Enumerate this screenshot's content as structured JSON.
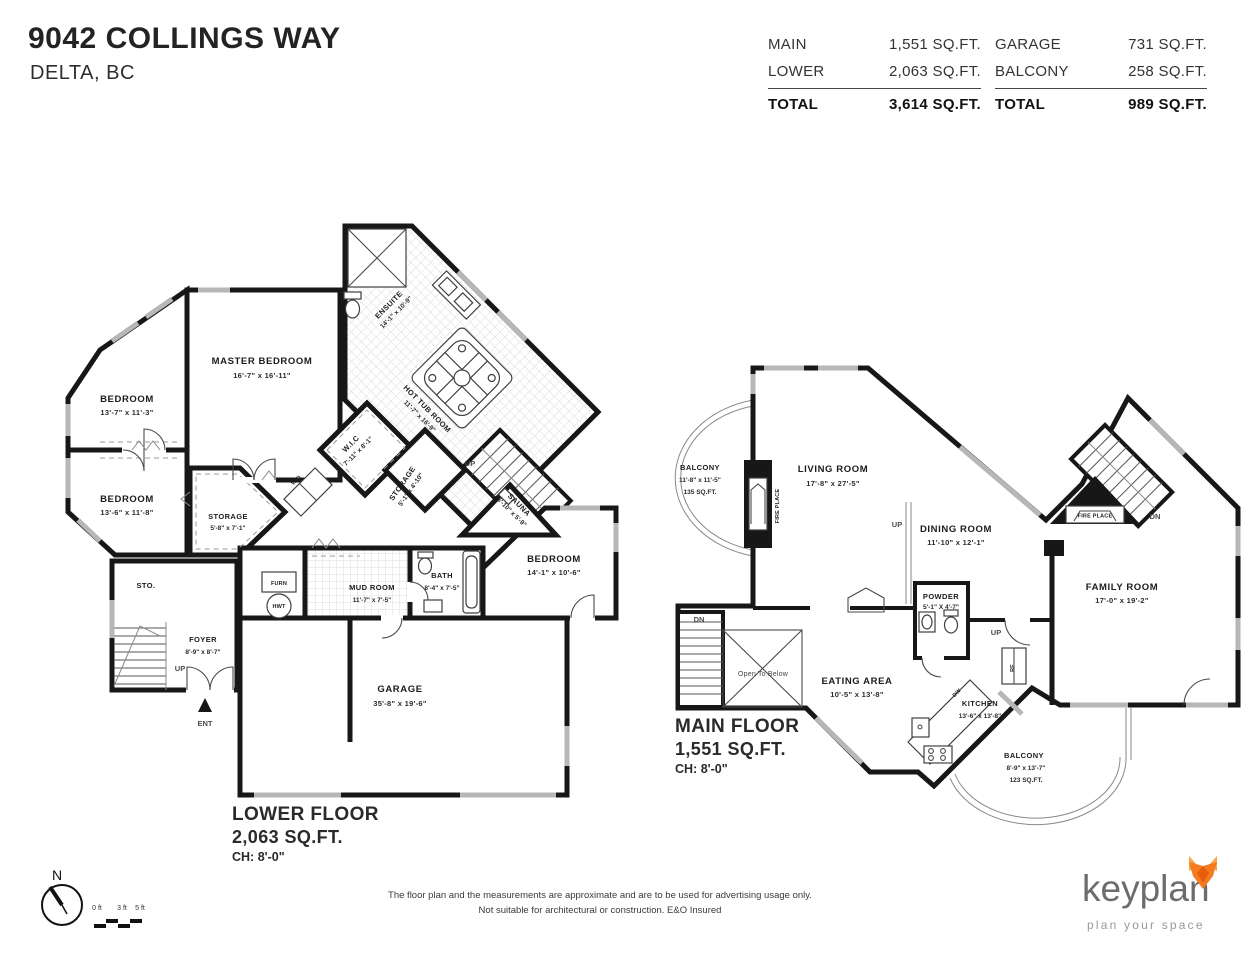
{
  "header": {
    "address": "9042 COLLINGS WAY",
    "city": "DELTA, BC",
    "table": {
      "left": {
        "rows": [
          {
            "label": "MAIN",
            "value": "1,551 SQ.FT."
          },
          {
            "label": "LOWER",
            "value": "2,063 SQ.FT."
          }
        ],
        "total_label": "TOTAL",
        "total_value": "3,614 SQ.FT."
      },
      "right": {
        "rows": [
          {
            "label": "GARAGE",
            "value": "731 SQ.FT."
          },
          {
            "label": "BALCONY",
            "value": "258 SQ.FT."
          }
        ],
        "total_label": "TOTAL",
        "total_value": "989 SQ.FT."
      }
    }
  },
  "lower_floor": {
    "title": "LOWER FLOOR",
    "area": "2,063 SQ.FT.",
    "ceiling": "CH: 8'-0\"",
    "rooms": {
      "master": {
        "name": "MASTER BEDROOM",
        "dims": "16'-7\" x 16'-11\""
      },
      "bedroom1": {
        "name": "BEDROOM",
        "dims": "13'-7\" x 11'-3\""
      },
      "bedroom2": {
        "name": "BEDROOM",
        "dims": "13'-6\" x 11'-8\""
      },
      "ensuite": {
        "name": "ENSUITE",
        "dims": "14'-1\" x 10'-9\""
      },
      "hot_tub": {
        "name": "HOT TUB ROOM",
        "dims": "11'-7\" x 16'-9\""
      },
      "wic": {
        "name": "W.I.C",
        "dims": "7'-11\" x 8'-1\""
      },
      "storage1": {
        "name": "STORAGE",
        "dims": "5'-8\" x 7'-1\""
      },
      "storage2": {
        "name": "STORAGE",
        "dims": "5'-1\" x 4'-10\""
      },
      "sauna": {
        "name": "SAUNA",
        "dims": "5'-10\" x 5'-9\""
      },
      "bedroom3": {
        "name": "BEDROOM",
        "dims": "14'-1\" x 10'-6\""
      },
      "mud_room": {
        "name": "MUD ROOM",
        "dims": "11'-7\" x 7'-5\""
      },
      "bath": {
        "name": "BATH",
        "dims": "8'-4\" x 7'-5\""
      },
      "sto": {
        "name": "STO."
      },
      "foyer": {
        "name": "FOYER",
        "dims": "8'-9\" x 8'-7\""
      },
      "garage": {
        "name": "GARAGE",
        "dims": "35'-8\" x 19'-6\""
      }
    },
    "labels": {
      "furn": "FURN",
      "hwt": "HWT",
      "wd": "W/D",
      "up_stairs": "UP",
      "up_foyer": "UP",
      "ent": "ENT"
    }
  },
  "main_floor": {
    "title": "MAIN FLOOR",
    "area": "1,551 SQ.FT.",
    "ceiling": "CH: 8'-0\"",
    "rooms": {
      "balcony_top": {
        "name": "BALCONY",
        "dims": "11'-8\" x 11'-5\"",
        "area": "135 SQ.FT."
      },
      "living": {
        "name": "LIVING ROOM",
        "dims": "17'-8\" x 27'-5\""
      },
      "dining": {
        "name": "DINING ROOM",
        "dims": "11'-10\" x 12'-1\""
      },
      "powder": {
        "name": "POWDER",
        "dims": "5'-1\" X 4'-7\""
      },
      "family": {
        "name": "FAMILY ROOM",
        "dims": "17'-0\" x 19'-2\""
      },
      "eating": {
        "name": "EATING AREA",
        "dims": "10'-5\" x 13'-8\""
      },
      "kitchen": {
        "name": "KITCHEN",
        "dims": "13'-6\" x 13'-8\""
      },
      "balcony_bottom": {
        "name": "BALCONY",
        "dims": "8'-9\" x 13'-7\"",
        "area": "123 SQ.FT."
      }
    },
    "labels": {
      "fireplace_living": "FIRE PLACE",
      "fireplace_family": "FIRE PLACE",
      "open_below": "Open To Below",
      "up_dining": "UP",
      "up_family": "UP",
      "dn_stairs": "DN",
      "dn_family": "DN",
      "rf": "RF",
      "dw": "DW"
    }
  },
  "footer": {
    "disclaimer1": "The floor plan and the measurements are approximate and are to be used for advertising usage only.",
    "disclaimer2": "Not suitable for architectural or construction. E&O Insured",
    "brand": "keyplan",
    "tagline": "plan your space",
    "north": "N",
    "scale": {
      "zero": "0 ft",
      "three": "3 ft",
      "five": "5 ft"
    }
  },
  "colors": {
    "wall": "#171717",
    "accent_orange": "#f47b20",
    "brand_gray": "#6a6c6e"
  }
}
